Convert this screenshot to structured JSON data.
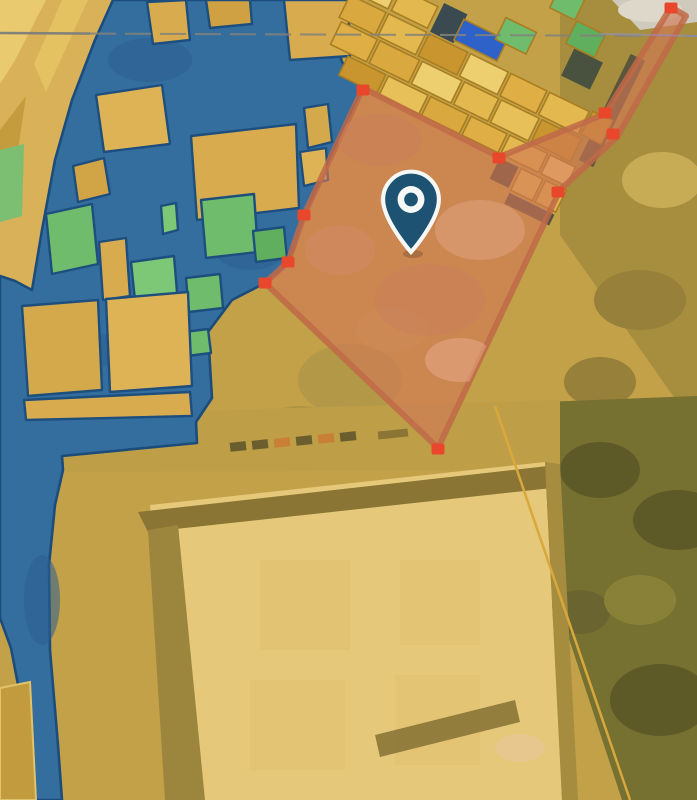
{
  "map": {
    "kind": "cadastral-parcel-selection-map",
    "palette": {
      "selection_fill": "#D27855",
      "selection_fill_opacity": 0.62,
      "selection_stroke": "#C06A48",
      "vertex_marker": "#E8472B",
      "pin": "#1E5273",
      "pin_ring": "#F5F8F6",
      "zone_overlay": "#336E9F",
      "zone_stroke": "#1C4C7C",
      "parcel_yellow": "#D8AC4E",
      "parcel_green": "#6FBC6C",
      "boundary_gray": "#82827A",
      "boundary_purple": "#8F8FC9",
      "cadastral_line": "#D9A83C"
    },
    "selected_parcel": {
      "vertices": [
        [
          363,
          88
        ],
        [
          499,
          157
        ],
        [
          605,
          114
        ],
        [
          671,
          7
        ],
        [
          686,
          16
        ],
        [
          617,
          137
        ],
        [
          560,
          190
        ],
        [
          438,
          448
        ],
        [
          265,
          283
        ],
        [
          288,
          262
        ],
        [
          304,
          215
        ]
      ],
      "vertex_markers": [
        [
          363,
          90
        ],
        [
          499,
          158
        ],
        [
          605,
          113
        ],
        [
          671,
          8
        ],
        [
          613,
          134
        ],
        [
          558,
          192
        ],
        [
          438,
          449
        ],
        [
          265,
          283
        ],
        [
          288,
          262
        ],
        [
          304,
          215
        ]
      ],
      "marker_width": 13,
      "marker_height": 11
    },
    "pin": {
      "x": 411,
      "y": 252
    },
    "boundary_line": {
      "y": 34
    }
  }
}
